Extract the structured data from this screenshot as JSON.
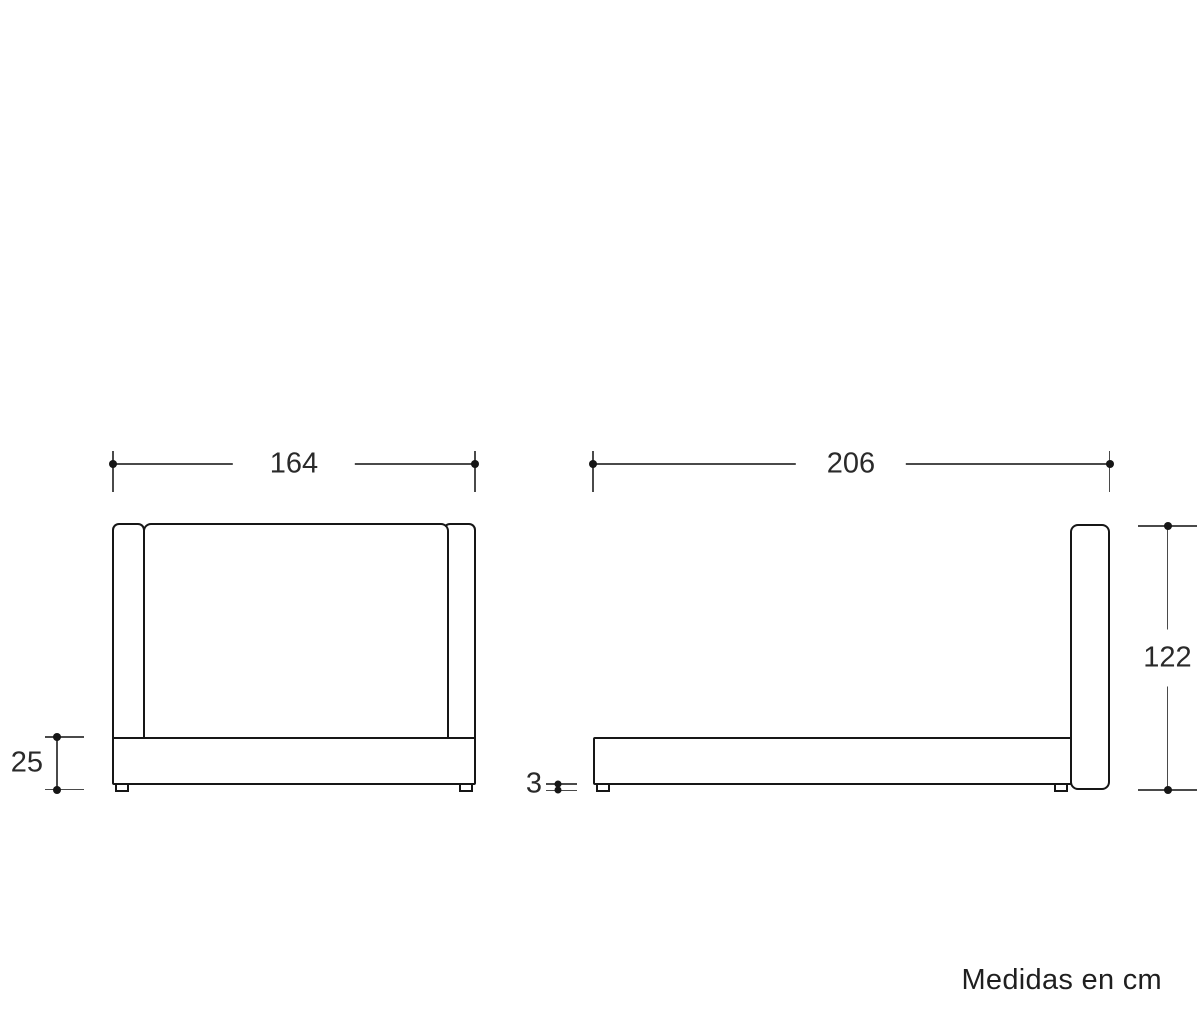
{
  "caption": "Medidas en cm",
  "dims": {
    "front_width": "164",
    "side_length": "206",
    "overall_height": "122",
    "base_height": "25",
    "leg_height": "3"
  },
  "colors": {
    "background": "#ffffff",
    "outline": "#161616",
    "dimension_line": "#4a4a4a",
    "text": "#2a2a2a"
  }
}
